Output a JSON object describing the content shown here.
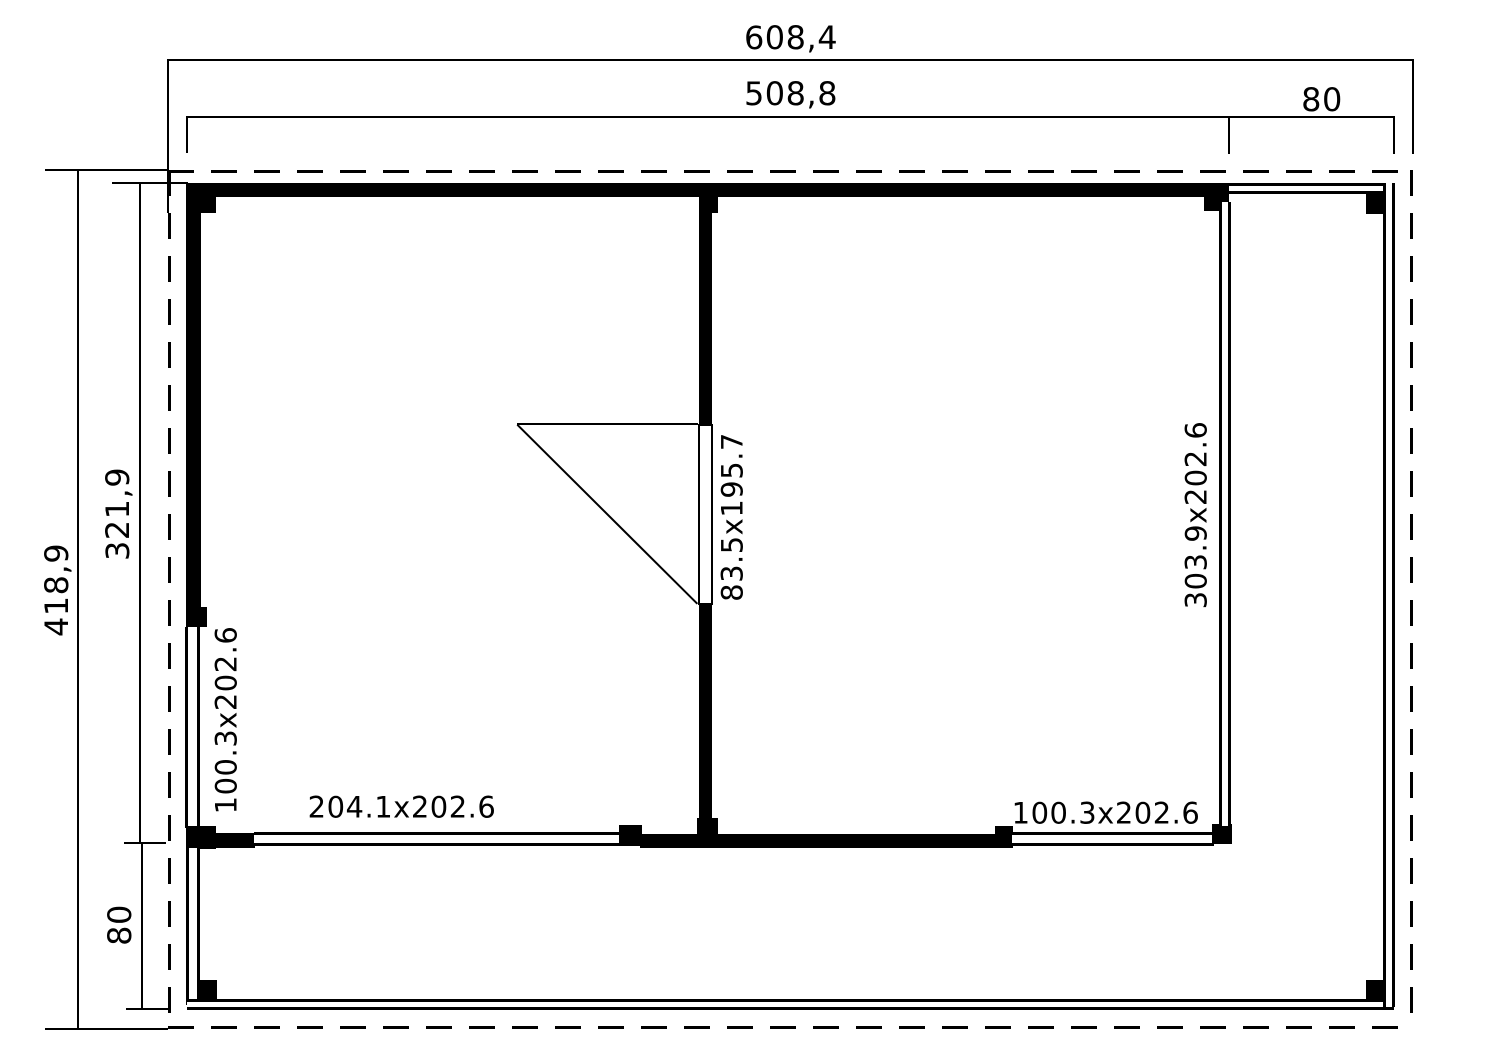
{
  "meta": {
    "drawing_type": "log-cabin floor plan, top view",
    "background_color": "#ffffff",
    "line_color": "#000000"
  },
  "dimensions": {
    "top": [
      {
        "id": "total-width",
        "label": "608,4"
      },
      {
        "id": "building-width",
        "label": "508,8"
      },
      {
        "id": "side-canopy-width",
        "label": "80"
      }
    ],
    "left": [
      {
        "id": "total-depth",
        "label": "418,9"
      },
      {
        "id": "building-depth",
        "label": "321,9"
      },
      {
        "id": "veranda-depth",
        "label": "80"
      }
    ]
  },
  "openings": {
    "door": {
      "label": "83.5x195.7"
    },
    "left_wall_window": {
      "label": "100.3x202.6"
    },
    "front_left_window": {
      "label": "204.1x202.6"
    },
    "front_right_window": {
      "label": "100.3x202.6"
    },
    "right_wall_glazing": {
      "label": "303.9x202.6"
    }
  }
}
